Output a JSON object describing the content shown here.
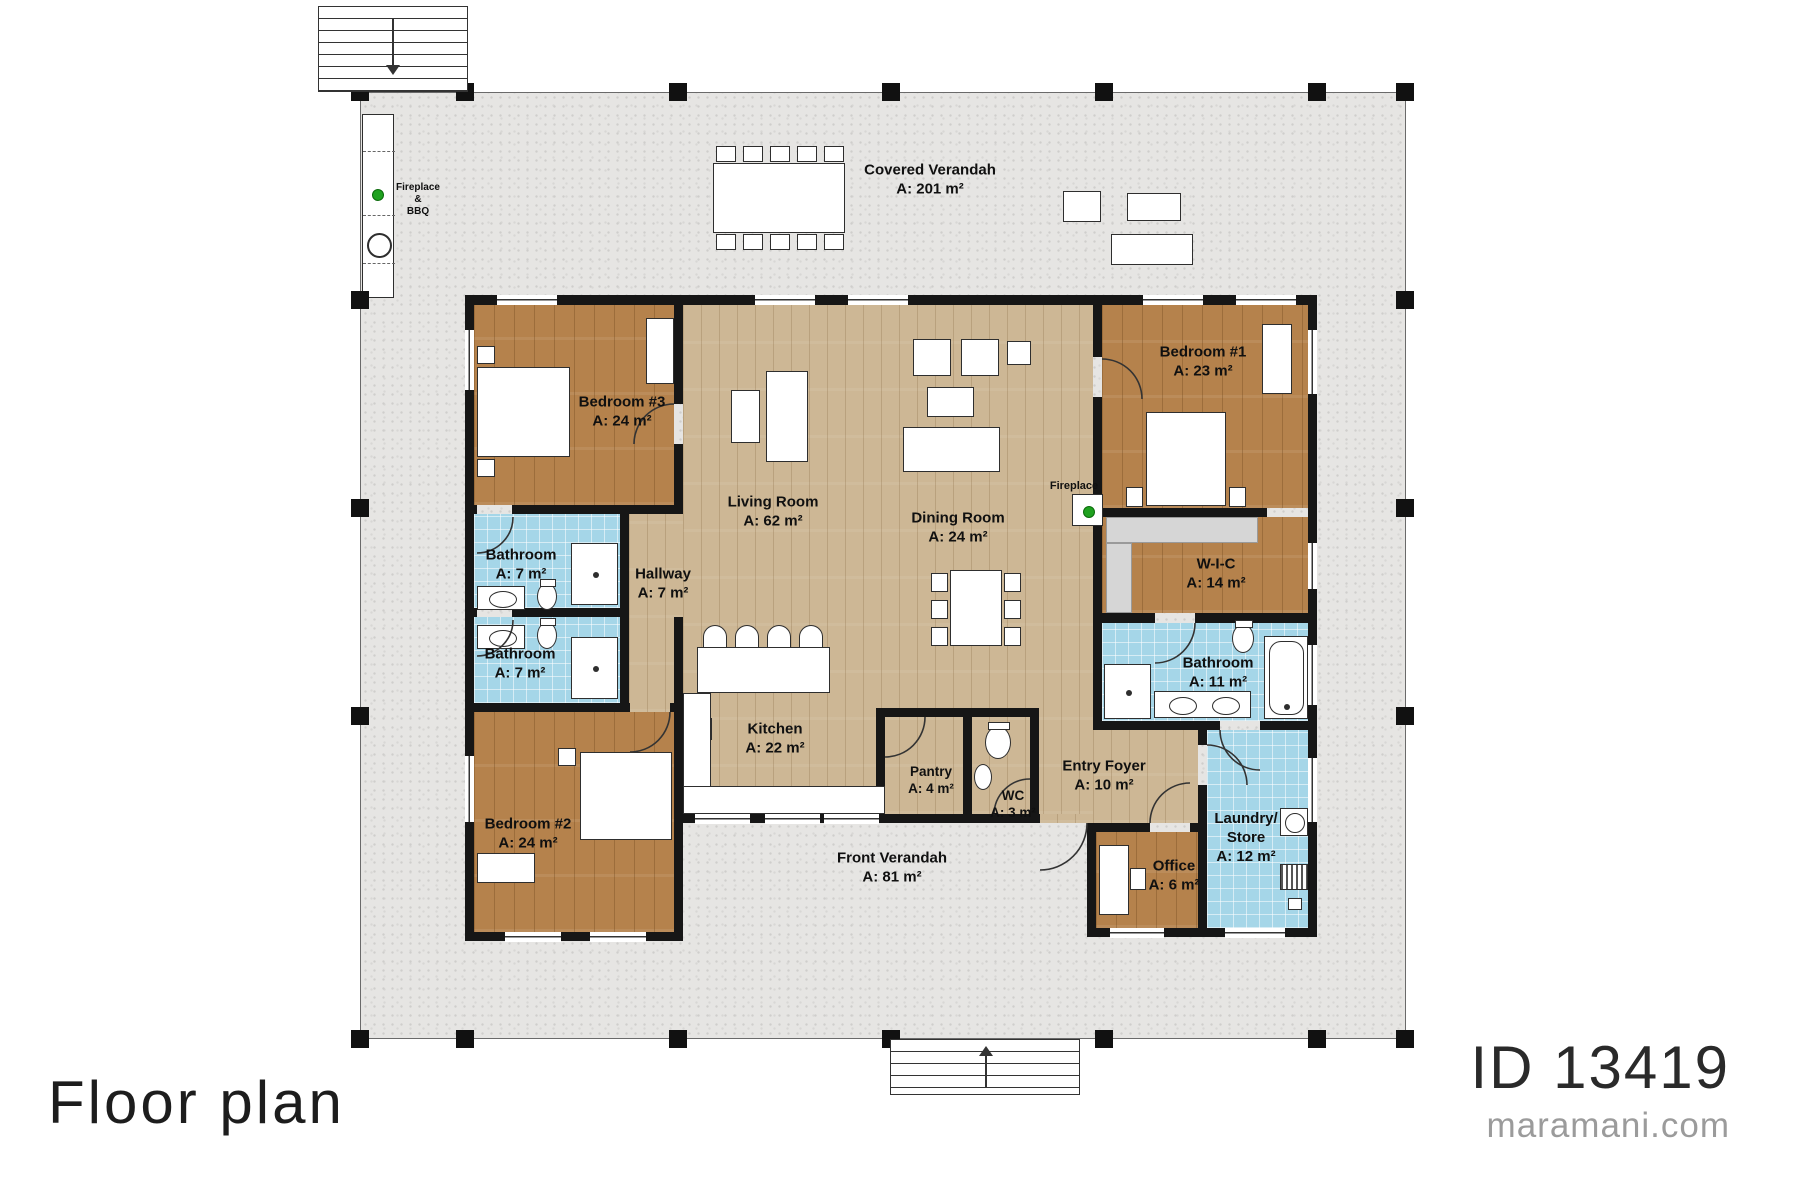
{
  "branding": {
    "plan_title": "Floor plan",
    "plan_id": "ID 13419",
    "website": "maramani.com"
  },
  "verandahs": {
    "covered": {
      "name": "Covered Verandah",
      "area": "A: 201 m²"
    },
    "front": {
      "name": "Front Verandah",
      "area": "A: 81 m²"
    }
  },
  "annotations": {
    "fireplace_bbq": [
      "Fireplace",
      "&",
      "BBQ"
    ],
    "fireplace": "Fireplace"
  },
  "rooms": [
    {
      "id": "bedroom-3",
      "name": "Bedroom #3",
      "area": "A: 24 m²"
    },
    {
      "id": "living-room",
      "name": "Living Room",
      "area": "A: 62 m²"
    },
    {
      "id": "dining-room",
      "name": "Dining Room",
      "area": "A: 24 m²"
    },
    {
      "id": "bedroom-1",
      "name": "Bedroom #1",
      "area": "A: 23 m²"
    },
    {
      "id": "wic",
      "name": "W-I-C",
      "area": "A: 14 m²"
    },
    {
      "id": "bathroom-main",
      "name": "Bathroom",
      "area": "A: 11 m²"
    },
    {
      "id": "bathroom-upper",
      "name": "Bathroom",
      "area": "A: 7 m²"
    },
    {
      "id": "bathroom-lower",
      "name": "Bathroom",
      "area": "A: 7 m²"
    },
    {
      "id": "hallway",
      "name": "Hallway",
      "area": "A: 7 m²"
    },
    {
      "id": "kitchen",
      "name": "Kitchen",
      "area": "A: 22 m²"
    },
    {
      "id": "pantry",
      "name": "Pantry",
      "area": "A: 4 m²"
    },
    {
      "id": "wc",
      "name": "WC",
      "area": "A: 3 m²"
    },
    {
      "id": "entry-foyer",
      "name": "Entry Foyer",
      "area": "A: 10 m²"
    },
    {
      "id": "laundry-store",
      "name": "Laundry/ Store",
      "area": "A: 12 m²"
    },
    {
      "id": "office",
      "name": "Office",
      "area": "A: 6 m²"
    },
    {
      "id": "bedroom-2",
      "name": "Bedroom #2",
      "area": "A: 24 m²"
    }
  ]
}
